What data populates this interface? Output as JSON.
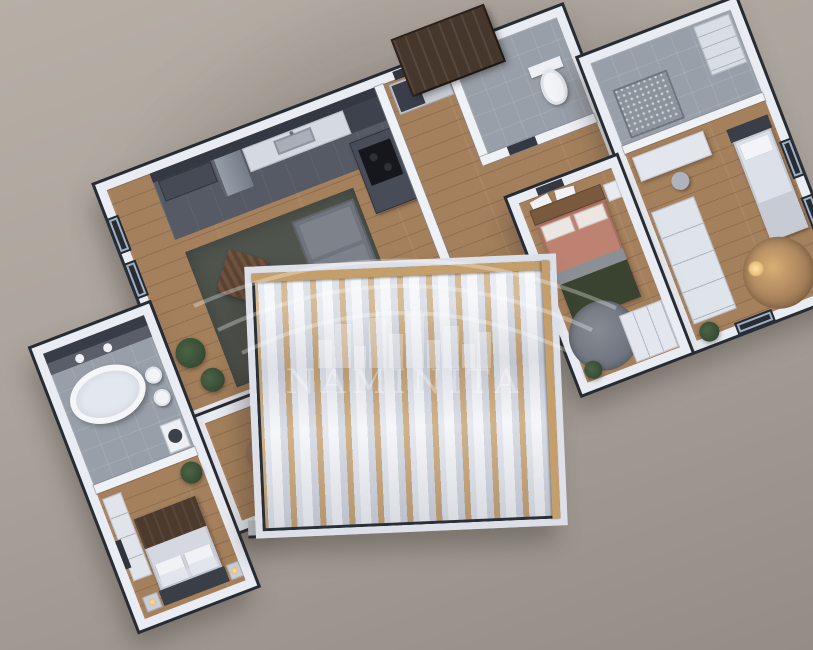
{
  "title": "3D apartment floor plan render, top-down view",
  "watermark": {
    "brand": "NAMINITA",
    "logo": "city-skyline-under-three-arcs",
    "color": "#ffffff",
    "opacity": 0.32
  },
  "colors": {
    "bg1": "#b6afa6",
    "bg2": "#948d85",
    "wall": "#e9ecf2",
    "outline": "#272b34",
    "wood": "#a5805c",
    "tile": "#999fa8",
    "tile_dark": "#565a64",
    "charcoal": "#343843",
    "rug": "#4f544d",
    "sofa": "#70747c",
    "island": "#484c56",
    "pergola_wood": "#c49e6b",
    "louver": "#f2f4f8",
    "terracotta": "#bd8272",
    "green_blanket": "#3a432f",
    "plant": "#3a5036",
    "glow": "#e9c27b"
  },
  "rooms": [
    {
      "id": "living-kitchen",
      "label": "Open living room with kitchen",
      "floor": "wood + dark tile",
      "furniture": [
        "corner-sofa",
        "lounge-chair",
        "coffee-table",
        "area-rug",
        "tv-sideboard",
        "fridge",
        "sink-counter",
        "kitchen-island-cooktop",
        "plants",
        "windows"
      ]
    },
    {
      "id": "entry-hall",
      "label": "Entry hall",
      "floor": "wood",
      "furniture": [
        "closet",
        "front-door",
        "entry-canopy-roof"
      ]
    },
    {
      "id": "wc",
      "label": "WC",
      "floor": "tile",
      "furniture": [
        "toilet"
      ]
    },
    {
      "id": "shower-room",
      "label": "Shower / storage room",
      "floor": "tile",
      "furniture": [
        "mosaic-wall",
        "tall-cabinet"
      ]
    },
    {
      "id": "bedroom-2",
      "label": "Bedroom with terracotta bedding",
      "floor": "wood",
      "furniture": [
        "double-bed",
        "green-blanket",
        "wardrobe",
        "round-rug",
        "wall-art",
        "nightstand",
        "plant"
      ]
    },
    {
      "id": "bedroom-3",
      "label": "Bedroom with desk",
      "floor": "wood",
      "furniture": [
        "bed",
        "desk",
        "chair",
        "wardrobe",
        "round-rug",
        "floor-lamp",
        "plant",
        "windows"
      ]
    },
    {
      "id": "bathroom",
      "label": "Bathroom",
      "floor": "tile",
      "furniture": [
        "freestanding-oval-bathtub",
        "vanity-with-two-sinks",
        "mirror-wall",
        "toilet",
        "bidet",
        "washing-machine"
      ]
    },
    {
      "id": "bedroom-1",
      "label": "Main bedroom",
      "floor": "wood",
      "furniture": [
        "double-bed",
        "brown-throw",
        "nightstands-with-lamps",
        "dresser",
        "plant",
        "wall-art"
      ]
    },
    {
      "id": "passage",
      "label": "Passage lounge",
      "floor": "wood",
      "furniture": [
        "armchair",
        "side-table",
        "plant"
      ]
    },
    {
      "id": "terrace",
      "label": "Terrace with louvered pergola",
      "floor": "deck",
      "furniture": [
        "wood-rafters",
        "white-fabric-louvers"
      ]
    }
  ]
}
